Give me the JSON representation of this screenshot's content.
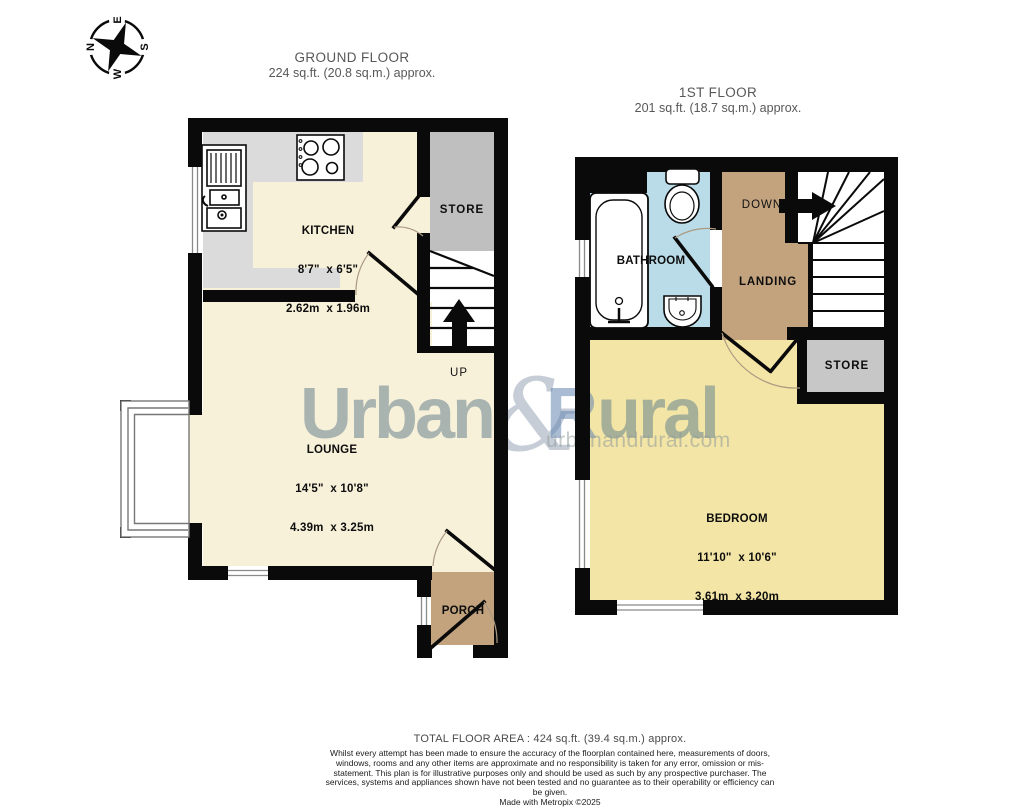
{
  "compass": {
    "n": "N",
    "e": "E",
    "s": "S",
    "w": "W"
  },
  "headings": {
    "ground": {
      "title": "GROUND FLOOR",
      "area": "224 sq.ft. (20.8 sq.m.) approx."
    },
    "first": {
      "title": "1ST FLOOR",
      "area": "201 sq.ft. (18.7 sq.m.) approx."
    }
  },
  "rooms": {
    "kitchen": {
      "name": "KITCHEN",
      "imperial": "8'7\"  x 6'5\"",
      "metric": "2.62m  x 1.96m"
    },
    "lounge": {
      "name": "LOUNGE",
      "imperial": "14'5\"  x 10'8\"",
      "metric": "4.39m  x 3.25m"
    },
    "bedroom": {
      "name": "BEDROOM",
      "imperial": "11'10\"  x 10'6\"",
      "metric": "3.61m  x 3.20m"
    },
    "store_ground": "STORE",
    "store_first": "STORE",
    "porch": "PORCH",
    "bathroom": "BATHROOM",
    "landing": "LANDING",
    "up": "UP",
    "down": "DOWN"
  },
  "watermark": {
    "word1": "Urban",
    "amp": "&",
    "word2_initial": "R",
    "word2_rest": "ural",
    "domain": "urbanandrural.com"
  },
  "footer": {
    "total": "TOTAL FLOOR AREA : 424 sq.ft. (39.4 sq.m.) approx.",
    "disclaimer": "Whilst every attempt has been made to ensure the accuracy of the floorplan contained here, measurements of doors, windows, rooms and any other items are approximate and no responsibility is taken for any error, omission or mis-statement. This plan is for illustrative purposes only and should be used as such by any prospective purchaser. The services, systems and appliances shown have not been tested and no guarantee as to their operability or efficiency can be given.",
    "madewith": "Made with Metropix ©2025"
  },
  "colors": {
    "wall": "#0a0a0a",
    "cream_floor": "#f8f1da",
    "bedroom_floor": "#f2e5a6",
    "counter_grey": "#dbdbdb",
    "store_grey_ground": "#bfbfbf",
    "store_grey_first": "#c7c7c7",
    "tan_floor": "#c3a37e",
    "bathroom_blue": "#badce8",
    "watermark_sage": "#5f7d8a",
    "watermark_blue": "#6485b0"
  }
}
